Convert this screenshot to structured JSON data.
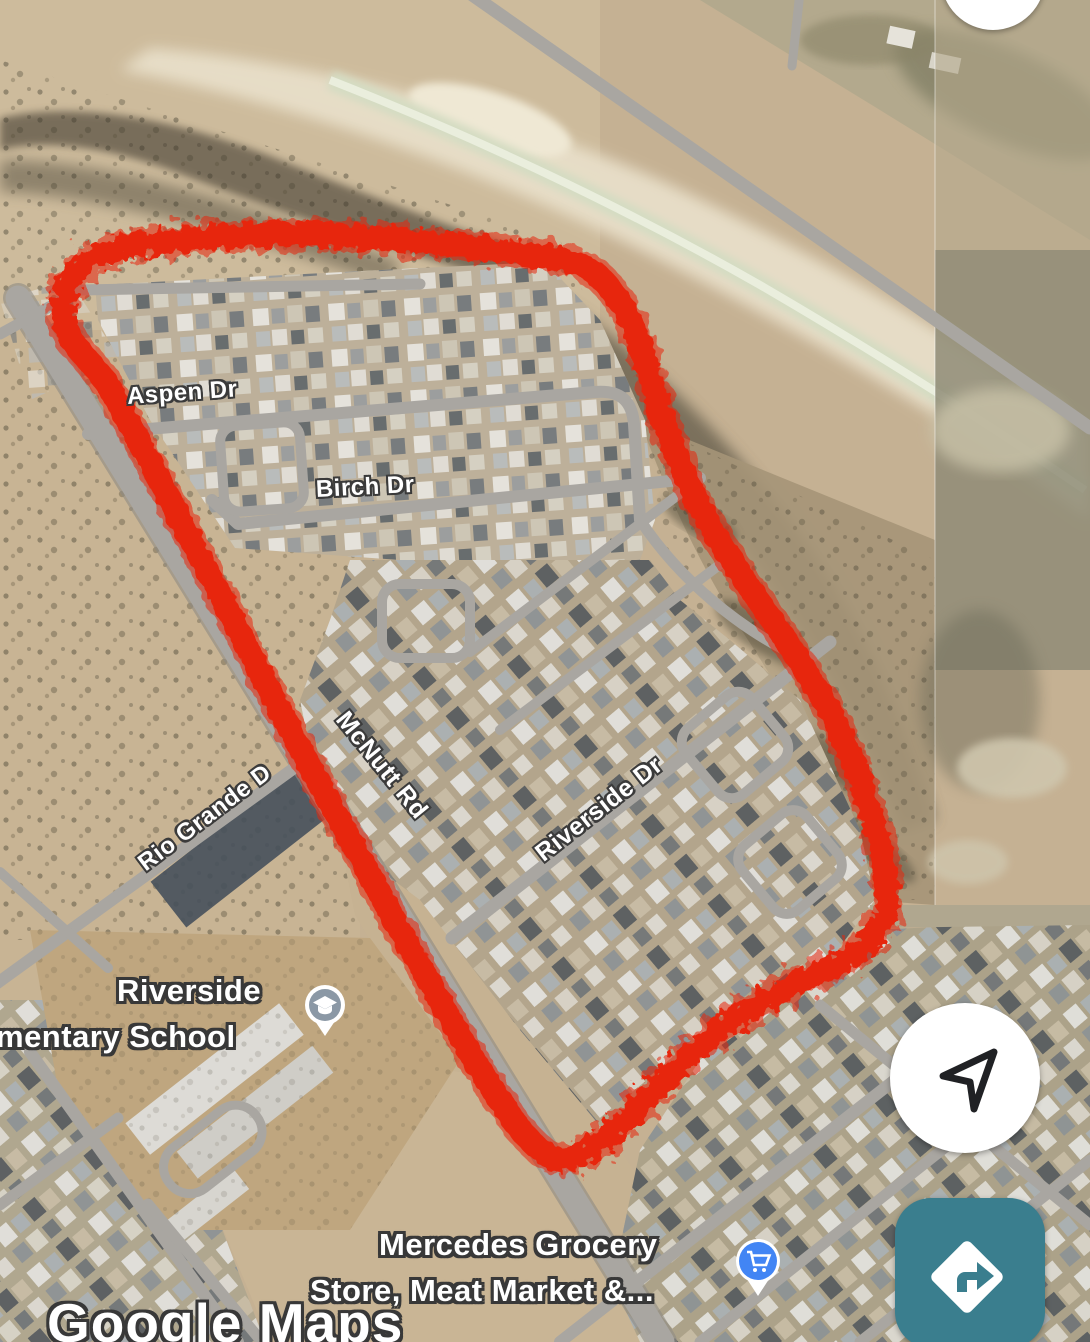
{
  "app": {
    "name": "Google Maps",
    "view_type": "satellite"
  },
  "watermark": {
    "text": "Google Maps"
  },
  "street_labels": {
    "aspen": "Aspen Dr",
    "birch": "Birch Dr",
    "mcnutt": "McNutt Rd",
    "rio_grande": "Rio Grande D",
    "riverside_dr": "Riverside Dr"
  },
  "pois": {
    "school": {
      "line1": "Riverside",
      "line2": "mentary School",
      "icon": "graduation-cap",
      "pin_color": "#8b98a5"
    },
    "grocery": {
      "line1": "Mercedes Grocery",
      "line2": "Store, Meat Market &...",
      "icon": "shopping-cart",
      "pin_color": "#4285f4"
    }
  },
  "annotation": {
    "type": "freehand-drawn-loop",
    "color": "#e7270e"
  },
  "controls": {
    "my_location_button": {
      "icon": "navigation-arrow"
    },
    "directions_button": {
      "icon": "turn-right-diamond",
      "color": "#3a7e8e"
    },
    "top_right_button": {
      "shape": "partial-white-circle"
    }
  }
}
